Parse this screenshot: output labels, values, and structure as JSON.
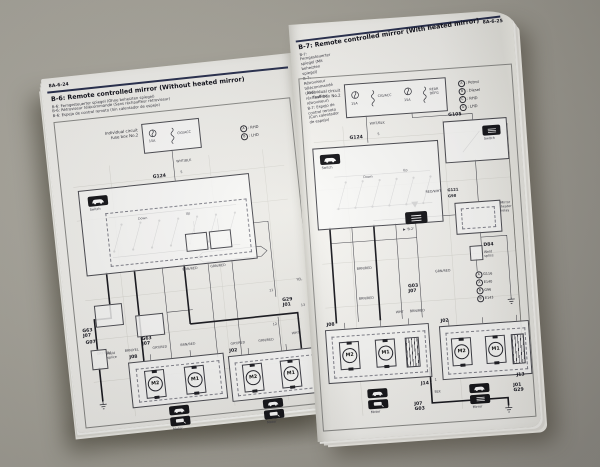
{
  "scene": {
    "background_color": "#a9a69c",
    "description": "Open workshop manual spread showing mirror wiring diagrams"
  },
  "left_page": {
    "page_number": "8A-6-24",
    "title": "B-6: Remote controlled mirror (Without heated mirror)",
    "subtitles": "B-6: Ferngesteuerter spiegel (Ohne beheizten spiegel)\nB-6: Rétroviseur télécommandé (Sans réchauffeur rétroviseur)\nB-6: Espejo de control remoto (Sin calentador de espejo)",
    "legend": [
      {
        "key": "A",
        "value": ": RHD"
      },
      {
        "key": "B",
        "value": ": LHD"
      }
    ],
    "fuse": {
      "label": "Individual circuit\nfuse box No.2",
      "rating": "15A",
      "circuit": "CIG/ACC"
    },
    "feed_wire": "WHT/BLK",
    "g124": "G124",
    "g124_pin": "5",
    "switch_caption": "Switch",
    "dir_down": "Down",
    "dir_up": "Up",
    "conn": {
      "g63a": "G63\nJ07",
      "g63b": "G63\nJ07",
      "g29": "G29\nJ01",
      "g29_pin": "13",
      "p11": "11",
      "p12": "12",
      "g07": "G07",
      "weld": "Weld\nsplice",
      "j08": "J08",
      "j02": "J02"
    },
    "mid_wires": [
      "BRN/RED",
      "GRN/RED"
    ],
    "bottom_wires": [
      "GRY/BLU",
      "BRN/YEL",
      "GRY/RED",
      "BRN/RED",
      "GRY/RED",
      "GRN/RED"
    ],
    "side_wires": {
      "wht": "WHT",
      "yel": "YEL"
    },
    "motor": {
      "m2": "M2",
      "m1": "M1"
    },
    "badge_captions": [
      "Motor",
      "Motor"
    ]
  },
  "right_page": {
    "page_number": "8A-6-25",
    "title": "B-7: Remote controlled mirror (With heated mirror)",
    "subtitles": "B-7: Ferngesteuerter spiegel (Mit beheizten spiegel)\nB-7: Rétroviseur télécommandé (Avec réchauffeur rétroviseur)\nB-7: Espejo de control remoto (Con calentador de espejo)",
    "legend": [
      {
        "key": "A",
        "value": ": Petrol"
      },
      {
        "key": "B",
        "value": ": Diesel"
      },
      {
        "key": "C",
        "value": ": RHD"
      },
      {
        "key": "D",
        "value": ": LHD"
      }
    ],
    "fuse": {
      "label": "Individual circuit\nfuse box No.2",
      "f1_rating": "15A",
      "f1_circuit": "CIG/ACC",
      "f2_rating": "15A",
      "f2_circuit": "REAR\nDEFG"
    },
    "feed_wire": "WHT/BLK",
    "g124": "G124",
    "g124_pin": "5",
    "switch_caption": "Switch",
    "dir_down": "Down",
    "dir_up": "Up",
    "g105": "G105",
    "defog_switch_caption": "Switch",
    "g121": "G121",
    "g98": "G98",
    "relay_caption": "Mirror\nheater\nrelay",
    "defog_ref": "▶ 'B-2'",
    "d84": "D84",
    "d84_caption": "Weld\nsplice",
    "conn_list": [
      {
        "key": "A",
        "value": "G116"
      },
      {
        "key": "A",
        "value": "E140"
      },
      {
        "key": "B",
        "value": "G96"
      },
      {
        "key": "B",
        "value": "E143"
      }
    ],
    "g03": "G03\nJ07",
    "wires": {
      "brn_red": "BRN/RED",
      "grn_red": "GRN/RED",
      "wht": "WHT",
      "blk": "BLK",
      "red_wht": "RED/WHT"
    },
    "conn": {
      "j08": "J08",
      "j02": "J02",
      "j14": "J14",
      "j14_pin": "1",
      "j07g03": "J07\nG03",
      "j13": "J13",
      "j01g29": "J01\nG29"
    },
    "motor": {
      "m2": "M2",
      "m1": "M1"
    },
    "badge_captions": [
      "Motor",
      "Mirror"
    ]
  }
}
